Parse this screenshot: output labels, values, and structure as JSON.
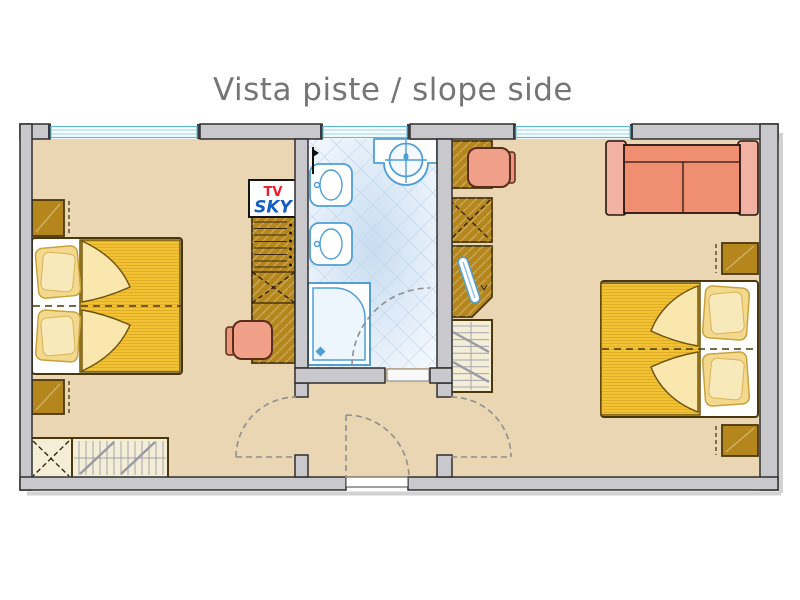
{
  "title": "Vista piste / slope side",
  "tv_unit": {
    "line1": "TV",
    "line2": "SKY"
  },
  "areas": {
    "left_room": {
      "name": "bedroom-left",
      "furniture": [
        "double-bed",
        "pillows",
        "nightstand-top",
        "nightstand-bottom",
        "tv-sky-cabinet",
        "shelf-unit",
        "wardrobe",
        "desk",
        "chair",
        "radiator",
        "storage-cabinet",
        "window",
        "door-swing"
      ]
    },
    "bathroom": {
      "name": "bathroom",
      "furniture": [
        "washbasin",
        "bidet",
        "toilet",
        "shower",
        "window",
        "door-swing"
      ]
    },
    "hallway": {
      "name": "entrance-hall",
      "furniture": [
        "entrance-door",
        "door-threshold"
      ]
    },
    "right_room": {
      "name": "bedroom-right",
      "furniture": [
        "sofa",
        "double-bed",
        "pillows",
        "nightstand-top",
        "nightstand-bottom",
        "desk",
        "chair",
        "wardrobe",
        "corner-tv-cabinet",
        "radiator",
        "window",
        "door-swing"
      ]
    }
  },
  "colors": {
    "title_text": "#757575",
    "wall": "#c9c9cd",
    "wall_outline": "#2f2f2f",
    "floor": "#ead6b2",
    "window_frame": "#5fb8d8",
    "bath_fixture_outline": "#4f9fd6",
    "tile_line": "#bdd4ea",
    "furniture_wood": "#b5861b",
    "furniture_outline": "#4a370c",
    "blanket": "#f2c232",
    "blanket_fold": "#f9e7ae",
    "pillow": "#f3d98d",
    "sofa": "#ef8e71",
    "sofa_arms": "#f2b2a3",
    "chair": "#f0a089",
    "radiator": "#f4eed6",
    "tv_text_red": "#e8212e",
    "sky_text_blue": "#1560be",
    "door_swing": "#8f8f8f"
  }
}
